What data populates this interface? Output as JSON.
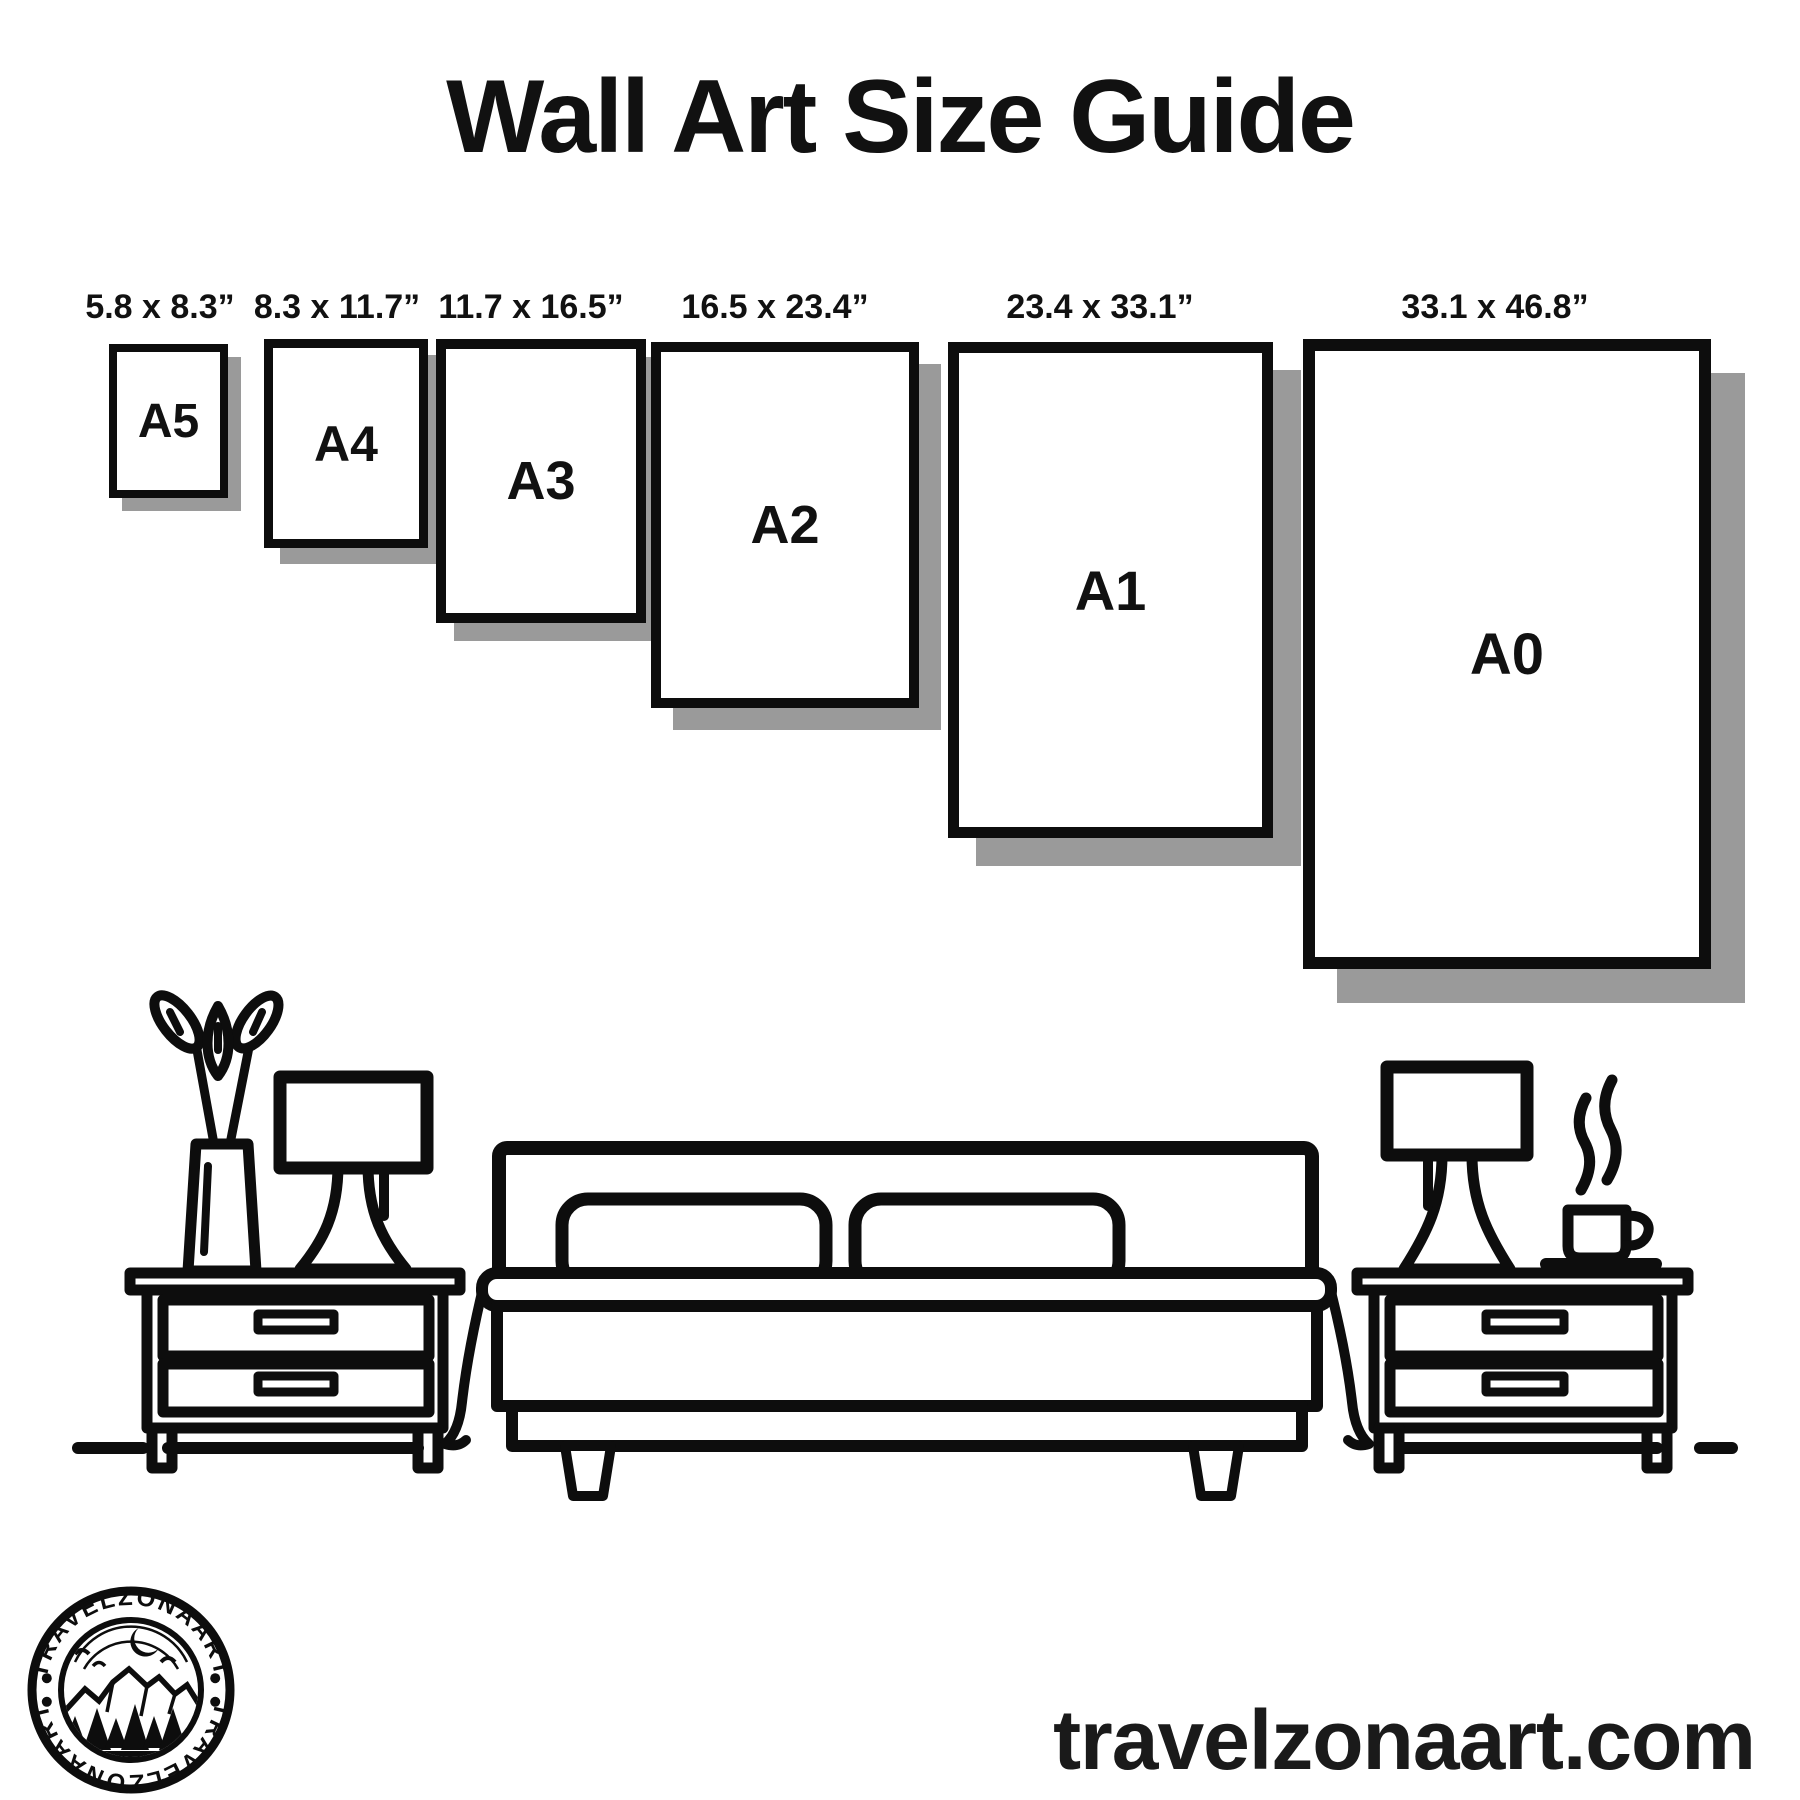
{
  "title": "Wall Art Size Guide",
  "sizes": [
    {
      "name": "A5",
      "dimensions": "5.8 x 8.3”"
    },
    {
      "name": "A4",
      "dimensions": "8.3 x 11.7”"
    },
    {
      "name": "A3",
      "dimensions": "11.7 x 16.5”"
    },
    {
      "name": "A2",
      "dimensions": "16.5 x 23.4”"
    },
    {
      "name": "A1",
      "dimensions": "23.4 x 33.1”"
    },
    {
      "name": "A0",
      "dimensions": "33.1 x 46.8”"
    }
  ],
  "logo": {
    "brand_top": "TRAVELZONAART",
    "brand_bottom": "TRAVELZONAART"
  },
  "website": "travelzonaart.com",
  "colors": {
    "ink": "#0d0d0d",
    "frame_shadow": "#9a9a9a",
    "background": "#ffffff"
  }
}
